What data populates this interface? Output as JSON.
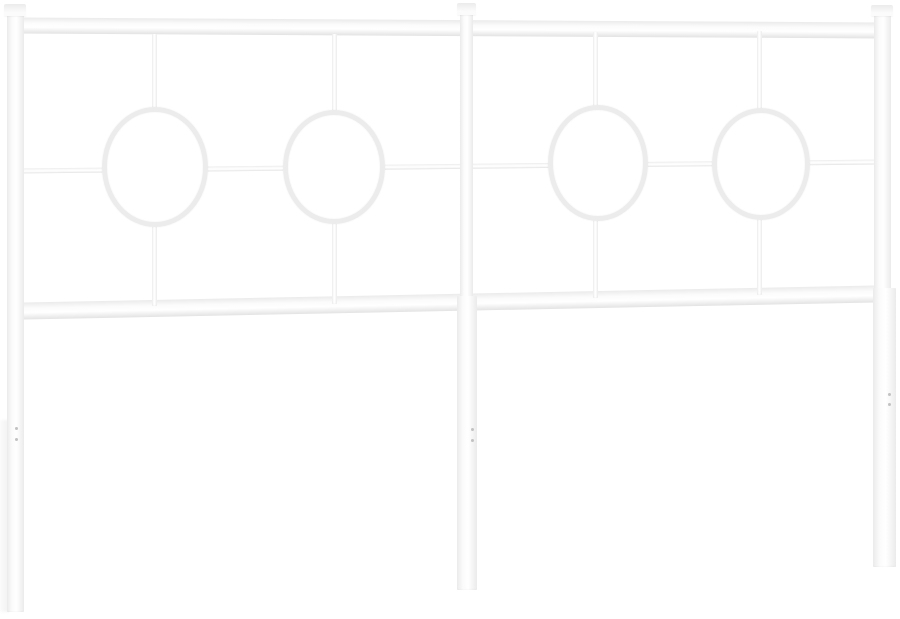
{
  "image": {
    "width": 900,
    "height": 619
  },
  "scene": {
    "description": "white-metal-headboard-product-photo",
    "background": "#ffffff"
  },
  "palette": {
    "bg": "#ffffff",
    "tube_hi": "#ffffff",
    "tube_mid": "#fbfbfb",
    "tube_edge": "#ebebeb",
    "tube_edge_dark": "#e3e3e3",
    "ring": "#ececec",
    "dot": "#c2c2c2"
  },
  "elements": [
    {
      "name": "left-leg-shadow",
      "cls": "shade z0",
      "x": 0,
      "y": 420,
      "w": 9,
      "h": 192
    },
    {
      "name": "top-rail",
      "cls": "h-tube z1",
      "x": 16,
      "y": 20,
      "w": 866,
      "h": 16,
      "r": 0.33
    },
    {
      "name": "middle-cross-rail",
      "cls": "h-tube z1",
      "x": 16,
      "y": 164,
      "w": 866,
      "h": 4.5,
      "r": -0.6
    },
    {
      "name": "bottom-rail",
      "cls": "h-tube z1",
      "x": 16,
      "y": 294,
      "w": 866,
      "h": 17,
      "r": -1.15
    },
    {
      "name": "circle1-vertical-bar",
      "cls": "v-tube z1",
      "x": 152,
      "y": 34,
      "w": 5,
      "h": 272
    },
    {
      "name": "circle2-vertical-bar",
      "cls": "v-tube z1",
      "x": 332,
      "y": 34,
      "w": 5,
      "h": 270
    },
    {
      "name": "circle3-vertical-bar",
      "cls": "v-tube z1",
      "x": 593,
      "y": 32,
      "w": 5,
      "h": 266
    },
    {
      "name": "circle4-vertical-bar",
      "cls": "v-tube z1",
      "x": 757,
      "y": 31,
      "w": 5,
      "h": 264
    },
    {
      "name": "decor-ring-1",
      "cls": "ring z2",
      "x": 102,
      "y": 107,
      "w": 106,
      "h": 120
    },
    {
      "name": "decor-ring-2",
      "cls": "ring z2",
      "x": 283,
      "y": 110,
      "w": 102,
      "h": 114
    },
    {
      "name": "decor-ring-3",
      "cls": "ring z2",
      "x": 548,
      "y": 105,
      "w": 100,
      "h": 116
    },
    {
      "name": "decor-ring-4",
      "cls": "ring z2",
      "x": 712,
      "y": 108,
      "w": 98,
      "h": 112
    },
    {
      "name": "left-post",
      "cls": "v-tube z3",
      "x": 7,
      "y": 15,
      "w": 17,
      "h": 597
    },
    {
      "name": "center-post",
      "cls": "v-tube z3",
      "x": 460,
      "y": 14,
      "w": 13,
      "h": 290
    },
    {
      "name": "center-leg",
      "cls": "v-tube z3",
      "x": 457,
      "y": 296,
      "w": 20,
      "h": 294
    },
    {
      "name": "right-post",
      "cls": "v-tube z3",
      "x": 874,
      "y": 15,
      "w": 17,
      "h": 280
    },
    {
      "name": "right-leg",
      "cls": "v-tube z3",
      "x": 873,
      "y": 288,
      "w": 23,
      "h": 279
    },
    {
      "name": "left-post-finial",
      "cls": "cap z4",
      "x": 4,
      "y": 4,
      "w": 22,
      "h": 12
    },
    {
      "name": "center-post-finial",
      "cls": "cap z4",
      "x": 457,
      "y": 3,
      "w": 19,
      "h": 12
    },
    {
      "name": "right-post-finial",
      "cls": "cap z4",
      "x": 871,
      "y": 5,
      "w": 22,
      "h": 11
    },
    {
      "name": "left-leg-screw-hole-top",
      "cls": "dot z5",
      "x": 15,
      "y": 427,
      "w": 3,
      "h": 3
    },
    {
      "name": "left-leg-screw-hole-bottom",
      "cls": "dot z5",
      "x": 15,
      "y": 438,
      "w": 3,
      "h": 3
    },
    {
      "name": "center-leg-screw-hole-top",
      "cls": "dot z5",
      "x": 471,
      "y": 428,
      "w": 3,
      "h": 3
    },
    {
      "name": "center-leg-screw-hole-bottom",
      "cls": "dot z5",
      "x": 471,
      "y": 439,
      "w": 3,
      "h": 3
    },
    {
      "name": "right-leg-screw-hole-top",
      "cls": "dot z5",
      "x": 888,
      "y": 393,
      "w": 3,
      "h": 3
    },
    {
      "name": "right-leg-screw-hole-bottom",
      "cls": "dot z5",
      "x": 888,
      "y": 403,
      "w": 3,
      "h": 3
    }
  ]
}
